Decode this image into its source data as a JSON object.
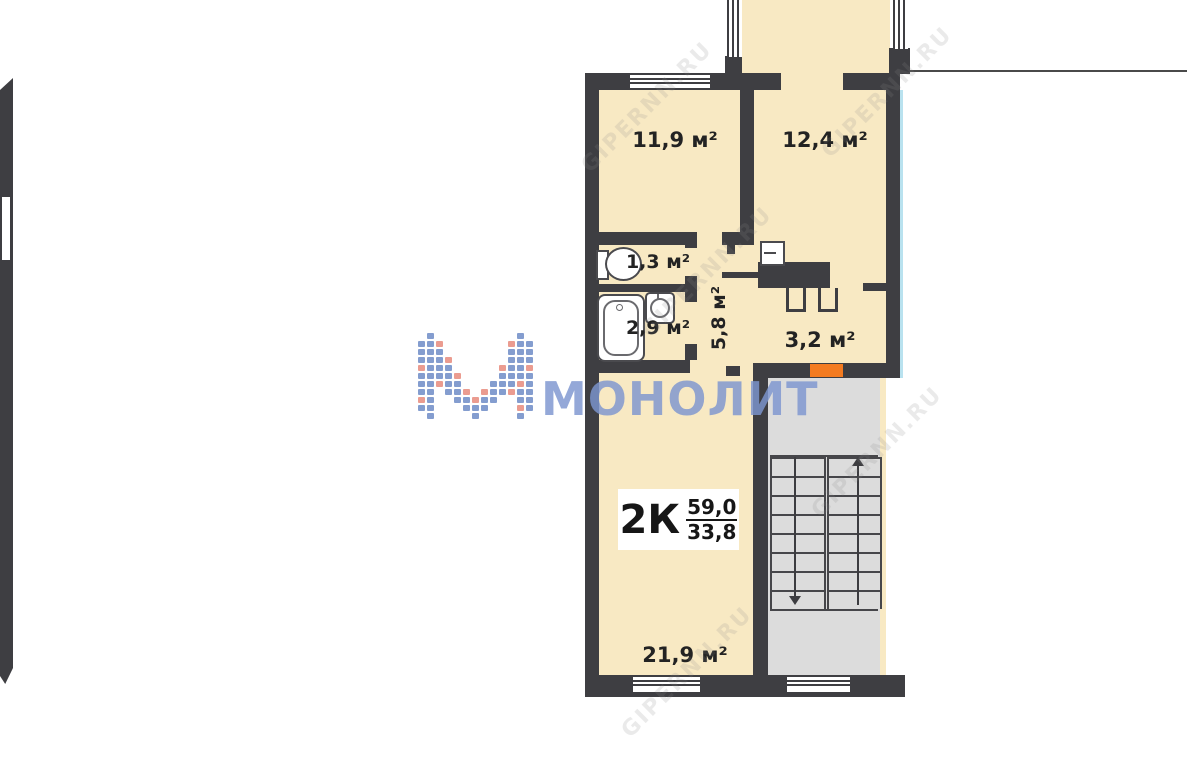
{
  "colors": {
    "wall": "#3e3e42",
    "cream": "#f8e9c3",
    "stair": "#dcdcdc",
    "accent": "#f47b20",
    "brand": "#7d96d0",
    "logoblue": "#6f8cc7",
    "logoorange": "#e88b7c",
    "blueline": "#b9e2ef",
    "ink": "#232323",
    "faint": "#8a8a8a"
  },
  "rooms": [
    {
      "id": "bedroom",
      "label": "11,9 м²"
    },
    {
      "id": "kitchen",
      "label": "12,4 м²"
    },
    {
      "id": "wc",
      "label": "1,3 м²"
    },
    {
      "id": "bathroom",
      "label": "2,9 м²"
    },
    {
      "id": "hallway",
      "label": "5,8 м²"
    },
    {
      "id": "entry-hall",
      "label": "3,2 м²"
    },
    {
      "id": "living-room",
      "label": "21,9 м²"
    }
  ],
  "apartment": {
    "type_label": "2К",
    "area_total": "59,0",
    "area_living": "33,8"
  },
  "brand": {
    "name": "МОНОЛИТ",
    "logo": {
      "blue": "#6f8cc7",
      "orange": "#e88b7c",
      "rows": [
        ".b.........b.",
        "bbo.......obb",
        "bbb.......bbb",
        "bbbo......bbb",
        "obbb.....obbo",
        "bbbbo....bbbb",
        "bbobb...bbbob",
        "bb.bbo.obbobb",
        "ob..bbobb..bb",
        "bb...bbb...ob",
        ".b....b....b."
      ]
    }
  },
  "site_watermark": {
    "text": "GIPERNN.RU"
  }
}
